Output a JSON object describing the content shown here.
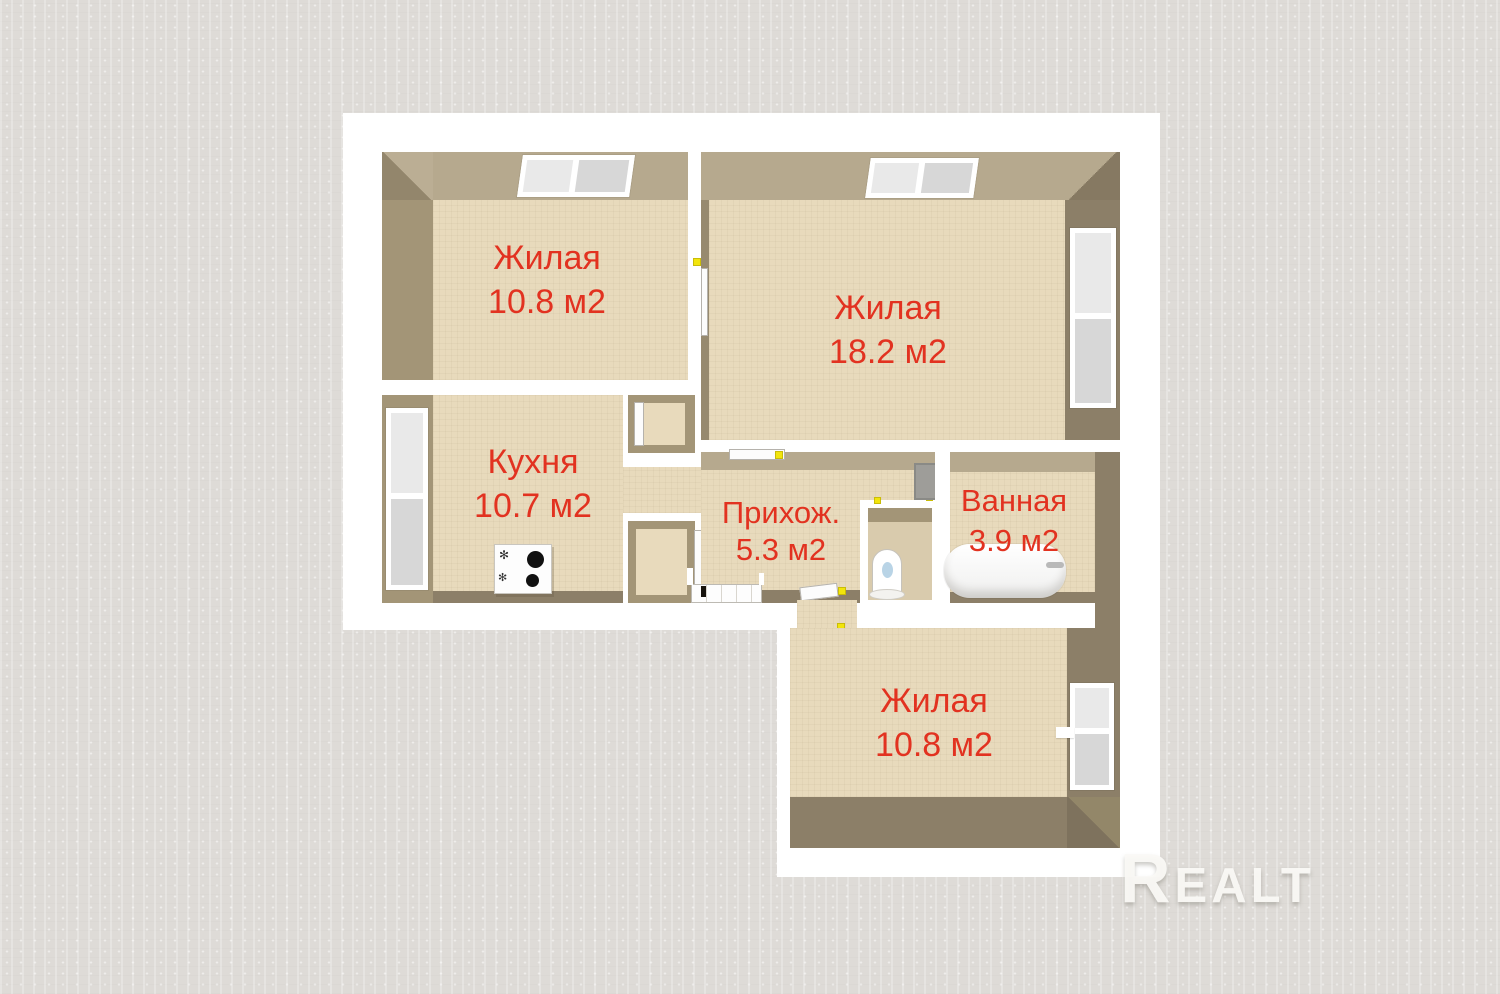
{
  "watermark": {
    "text": "Realt"
  },
  "rooms": [
    {
      "id": "living-top-left",
      "name": "Жилая",
      "area": "10.8 м2"
    },
    {
      "id": "living-top-right",
      "name": "Жилая",
      "area": "18.2 м2"
    },
    {
      "id": "kitchen",
      "name": "Кухня",
      "area": "10.7 м2"
    },
    {
      "id": "hallway",
      "name": "Прихож.",
      "area": "5.3 м2"
    },
    {
      "id": "bathroom",
      "name": "Ванная",
      "area": "3.9 м2"
    },
    {
      "id": "living-bottom",
      "name": "Жилая",
      "area": "10.8 м2"
    }
  ],
  "icons": [
    "window-icon",
    "door-icon",
    "door-handle-icon",
    "stove-icon",
    "toilet-icon",
    "bathtub-icon",
    "vent-shaft-icon",
    "entrance-mat-icon"
  ],
  "colors": {
    "label_red": "#e23220",
    "floor_beige": "#e8dabc",
    "wall_light": "#b6a98e",
    "wall_medium": "#a39577",
    "wall_dark": "#8c7f68",
    "outer_wall_white": "#ffffff",
    "background_gray": "#dedbd7",
    "handle_yellow": "#f2e50c"
  }
}
